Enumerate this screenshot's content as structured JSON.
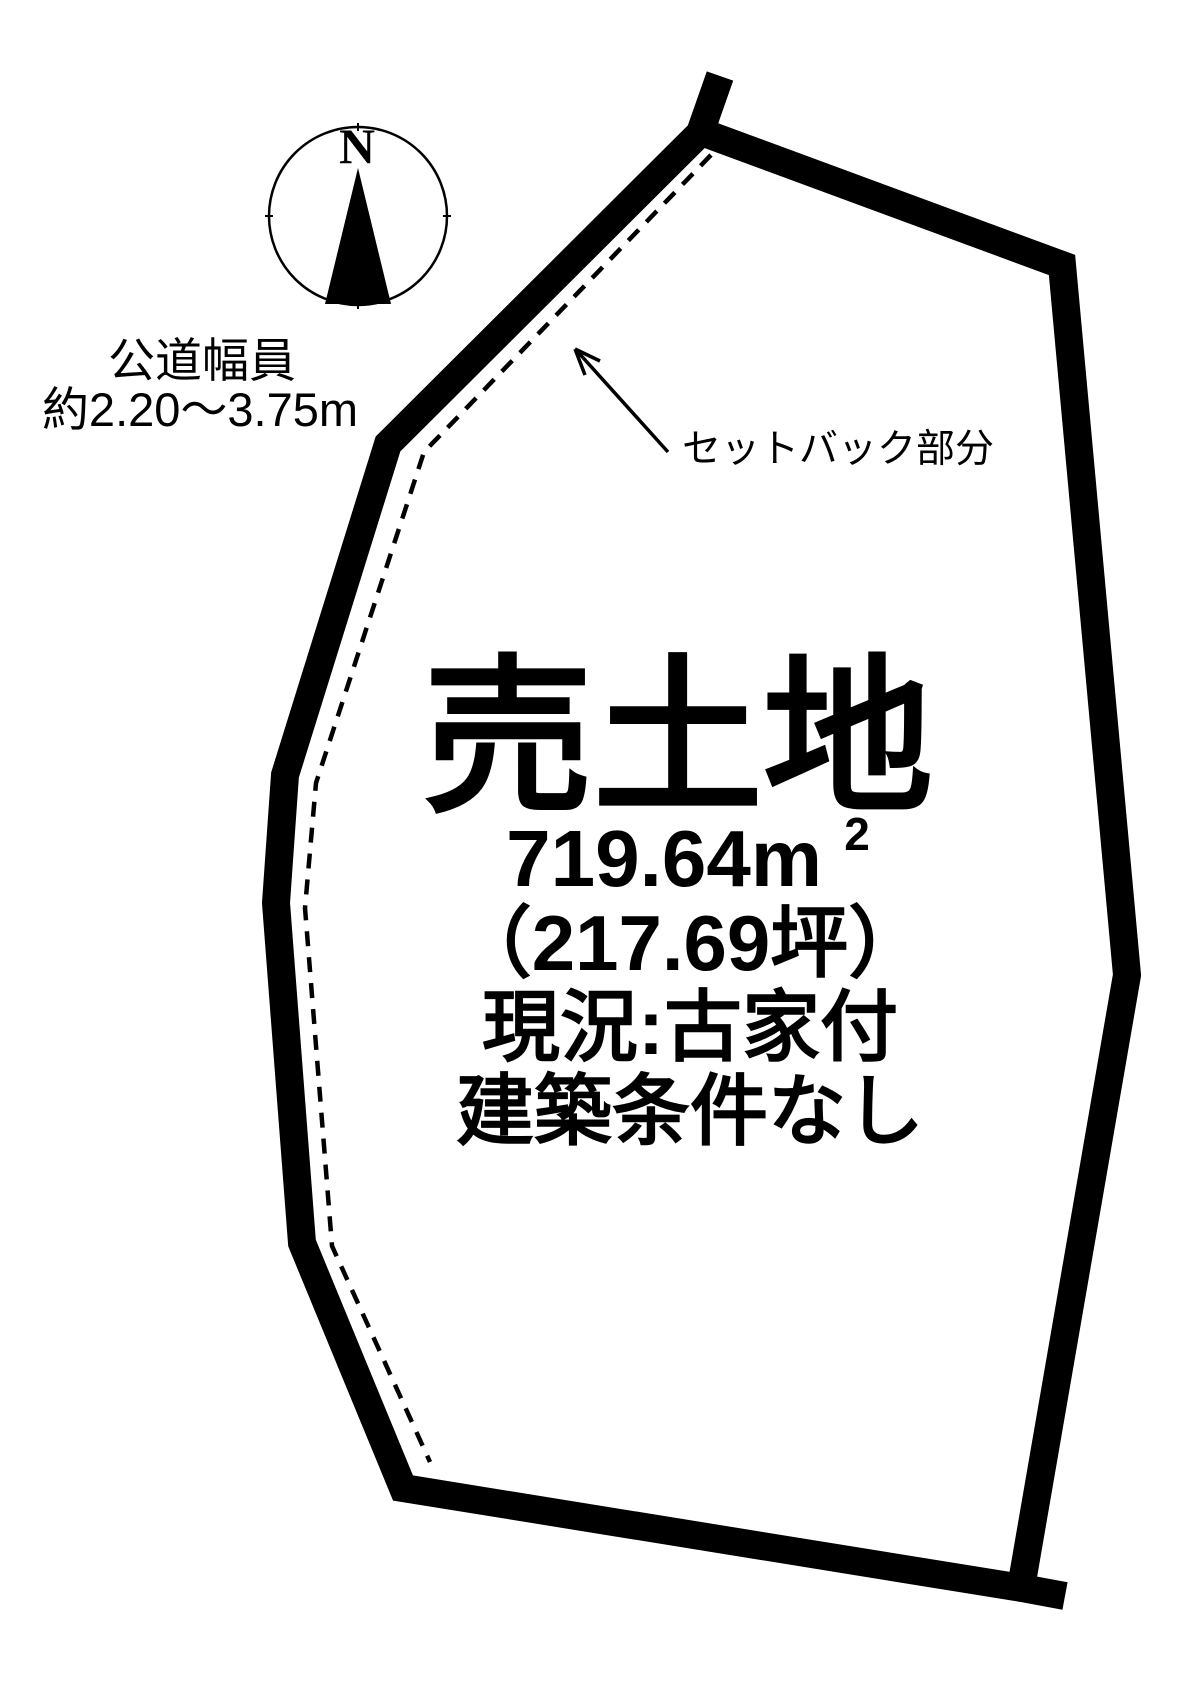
{
  "colors": {
    "ink": "#000000",
    "background": "#ffffff"
  },
  "compass": {
    "north_label": "N"
  },
  "road": {
    "label_line1": "公道幅員",
    "label_line2": "約2.20～3.75m"
  },
  "setback": {
    "label": "セットバック部分"
  },
  "parcel": {
    "title": "売土地",
    "area_m2": "719.64m",
    "area_m2_superscript": "2",
    "area_tsubo": "（217.69坪）",
    "current_status": "現況:古家付",
    "building_conditions": "建築条件なし"
  }
}
